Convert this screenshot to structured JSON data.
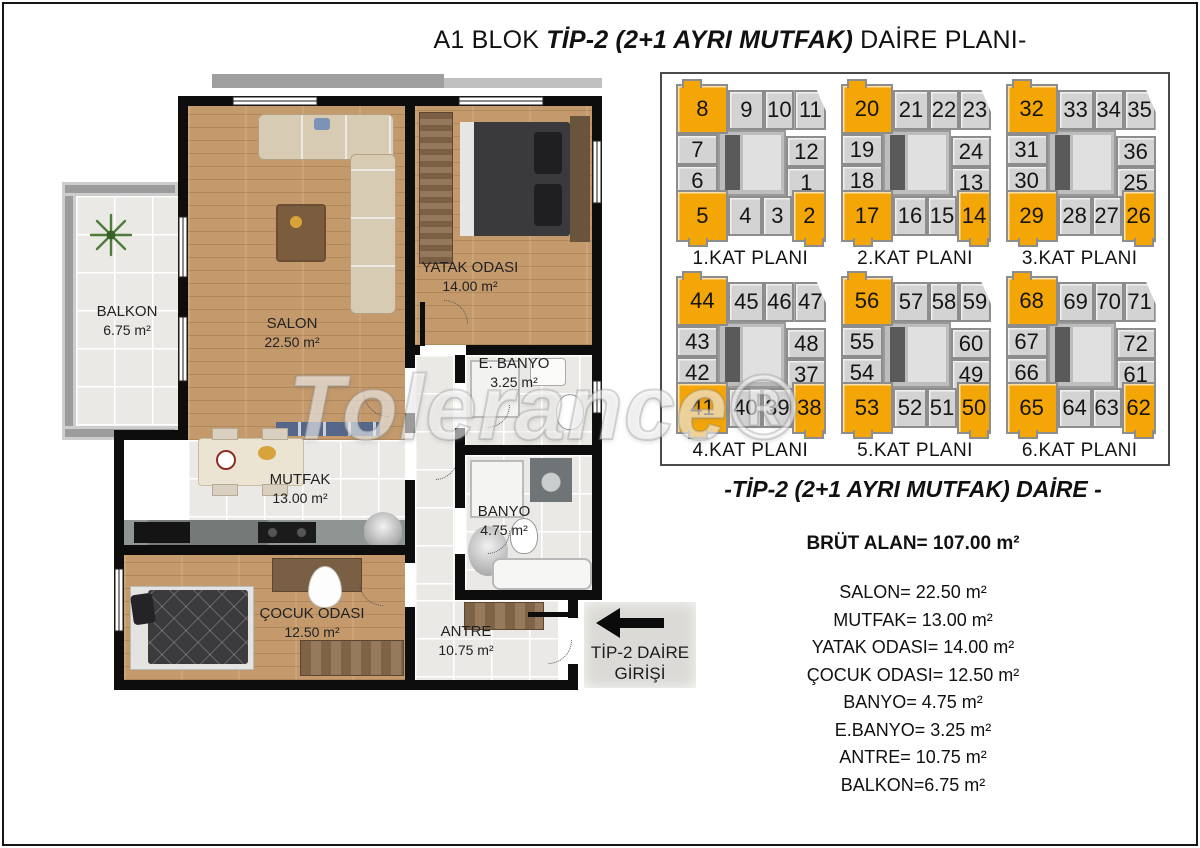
{
  "title": {
    "prefix": "A1 BLOK ",
    "emphasis": "TİP-2 (2+1 AYRI MUTFAK)",
    "suffix": " DAİRE PLANI-"
  },
  "watermark": "Tolerance®",
  "plan": {
    "rooms": {
      "balkon": {
        "name": "BALKON",
        "area": "6.75 m²"
      },
      "salon": {
        "name": "SALON",
        "area": "22.50 m²"
      },
      "yatak": {
        "name": "YATAK ODASI",
        "area": "14.00 m²"
      },
      "ebanyo": {
        "name": "E. BANYO",
        "area": "3.25 m²"
      },
      "mutfak": {
        "name": "MUTFAK",
        "area": "13.00 m²"
      },
      "banyo": {
        "name": "BANYO",
        "area": "4.75 m²"
      },
      "cocuk": {
        "name": "ÇOCUK ODASI",
        "area": "12.50 m²"
      },
      "antre": {
        "name": "ANTRE",
        "area": "10.75 m²"
      }
    },
    "entrance": {
      "line1": "TİP-2 DAİRE",
      "line2": "GİRİŞİ"
    }
  },
  "key_plans": {
    "highlight_color": "#f5a607",
    "cell_color": "#d3d3d3",
    "floors": [
      {
        "label": "1.KAT PLANI",
        "top": [
          "8",
          "9",
          "10",
          "11"
        ],
        "left": [
          "7",
          "6"
        ],
        "right": [
          "12",
          "1"
        ],
        "bottom": [
          "5",
          "4",
          "3",
          "2"
        ],
        "highlighted": [
          "8",
          "5",
          "2"
        ]
      },
      {
        "label": "2.KAT PLANI",
        "top": [
          "20",
          "21",
          "22",
          "23"
        ],
        "left": [
          "19",
          "18"
        ],
        "right": [
          "24",
          "13"
        ],
        "bottom": [
          "17",
          "16",
          "15",
          "14"
        ],
        "highlighted": [
          "20",
          "17",
          "14"
        ]
      },
      {
        "label": "3.KAT PLANI",
        "top": [
          "32",
          "33",
          "34",
          "35"
        ],
        "left": [
          "31",
          "30"
        ],
        "right": [
          "36",
          "25"
        ],
        "bottom": [
          "29",
          "28",
          "27",
          "26"
        ],
        "highlighted": [
          "32",
          "29",
          "26"
        ]
      },
      {
        "label": "4.KAT PLANI",
        "top": [
          "44",
          "45",
          "46",
          "47"
        ],
        "left": [
          "43",
          "42"
        ],
        "right": [
          "48",
          "37"
        ],
        "bottom": [
          "41",
          "40",
          "39",
          "38"
        ],
        "highlighted": [
          "44",
          "41",
          "38"
        ]
      },
      {
        "label": "5.KAT PLANI",
        "top": [
          "56",
          "57",
          "58",
          "59"
        ],
        "left": [
          "55",
          "54"
        ],
        "right": [
          "60",
          "49"
        ],
        "bottom": [
          "53",
          "52",
          "51",
          "50"
        ],
        "highlighted": [
          "56",
          "53",
          "50"
        ]
      },
      {
        "label": "6.KAT PLANI",
        "top": [
          "68",
          "69",
          "70",
          "71"
        ],
        "left": [
          "67",
          "66"
        ],
        "right": [
          "72",
          "61"
        ],
        "bottom": [
          "65",
          "64",
          "63",
          "62"
        ],
        "highlighted": [
          "68",
          "65",
          "62"
        ]
      }
    ]
  },
  "summary": {
    "heading": "-TİP-2 (2+1 AYRI MUTFAK) DAİRE -",
    "gross_area": "BRÜT ALAN= 107.00 m²",
    "items": [
      "SALON= 22.50 m²",
      "MUTFAK= 13.00 m²",
      "YATAK ODASI= 14.00 m²",
      "ÇOCUK ODASI= 12.50 m²",
      "BANYO= 4.75 m²",
      "E.BANYO= 3.25 m²",
      "ANTRE= 10.75 m²",
      "BALKON=6.75 m²"
    ]
  }
}
